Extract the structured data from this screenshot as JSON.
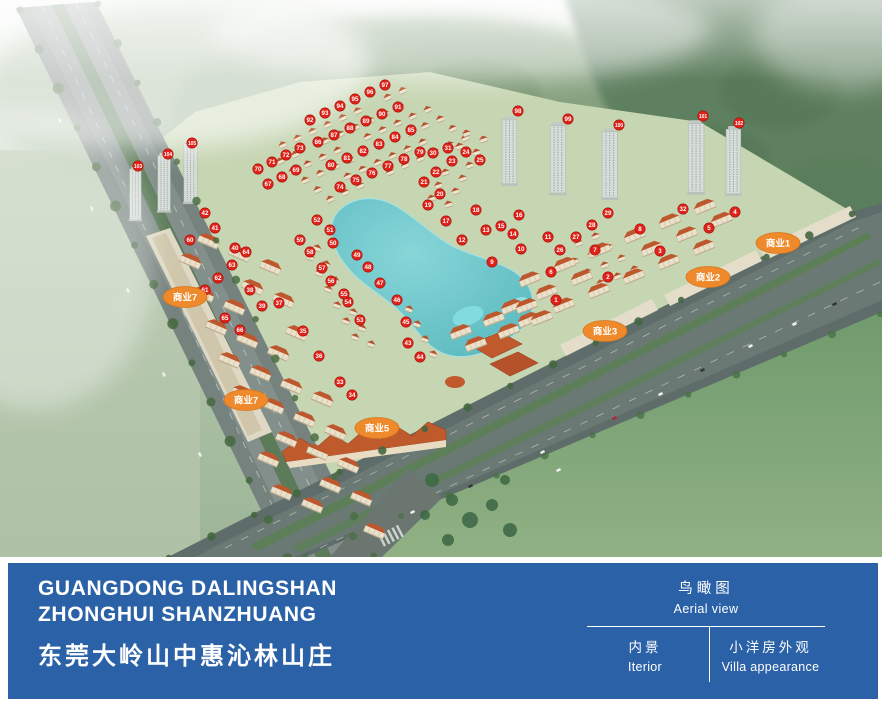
{
  "footer": {
    "bar_color": "#2b61a6",
    "title_en_line1": "GUANGDONG DALINGSHAN",
    "title_en_line2": "ZHONGHUI SHANZHUANG",
    "title_cn": "东莞大岭山中惠沁林山庄",
    "nav": {
      "active": {
        "cn": "鸟瞰图",
        "en": "Aerial view"
      },
      "items": [
        {
          "cn": "内景",
          "en": "Iterior"
        },
        {
          "cn": "小洋房外观",
          "en": "Villa appearance"
        }
      ]
    }
  },
  "aerial": {
    "marker_color": "#e0231a",
    "label_color": "#ee8a2b",
    "commercial_labels": [
      {
        "text": "商业1",
        "x": 778,
        "y": 243
      },
      {
        "text": "商业2",
        "x": 708,
        "y": 277
      },
      {
        "text": "商业3",
        "x": 605,
        "y": 331
      },
      {
        "text": "商业5",
        "x": 377,
        "y": 428
      },
      {
        "text": "商业7",
        "x": 185,
        "y": 297
      },
      {
        "text": "商业7",
        "x": 246,
        "y": 400
      }
    ],
    "unit_markers": [
      {
        "n": "1",
        "x": 556,
        "y": 300
      },
      {
        "n": "2",
        "x": 608,
        "y": 277
      },
      {
        "n": "3",
        "x": 660,
        "y": 251
      },
      {
        "n": "4",
        "x": 735,
        "y": 212
      },
      {
        "n": "5",
        "x": 709,
        "y": 228
      },
      {
        "n": "6",
        "x": 551,
        "y": 272
      },
      {
        "n": "7",
        "x": 595,
        "y": 250
      },
      {
        "n": "8",
        "x": 640,
        "y": 229
      },
      {
        "n": "9",
        "x": 492,
        "y": 262
      },
      {
        "n": "10",
        "x": 521,
        "y": 249
      },
      {
        "n": "11",
        "x": 548,
        "y": 237
      },
      {
        "n": "12",
        "x": 462,
        "y": 240
      },
      {
        "n": "13",
        "x": 486,
        "y": 230
      },
      {
        "n": "14",
        "x": 513,
        "y": 234
      },
      {
        "n": "15",
        "x": 501,
        "y": 226
      },
      {
        "n": "16",
        "x": 519,
        "y": 215
      },
      {
        "n": "17",
        "x": 446,
        "y": 221
      },
      {
        "n": "18",
        "x": 476,
        "y": 210
      },
      {
        "n": "19",
        "x": 428,
        "y": 205
      },
      {
        "n": "20",
        "x": 440,
        "y": 194
      },
      {
        "n": "21",
        "x": 424,
        "y": 182
      },
      {
        "n": "22",
        "x": 436,
        "y": 172
      },
      {
        "n": "23",
        "x": 452,
        "y": 161
      },
      {
        "n": "24",
        "x": 466,
        "y": 152
      },
      {
        "n": "25",
        "x": 480,
        "y": 160
      },
      {
        "n": "26",
        "x": 560,
        "y": 250
      },
      {
        "n": "27",
        "x": 576,
        "y": 237
      },
      {
        "n": "28",
        "x": 592,
        "y": 225
      },
      {
        "n": "29",
        "x": 608,
        "y": 213
      },
      {
        "n": "30",
        "x": 433,
        "y": 153
      },
      {
        "n": "31",
        "x": 448,
        "y": 148
      },
      {
        "n": "32",
        "x": 683,
        "y": 209
      },
      {
        "n": "33",
        "x": 340,
        "y": 382
      },
      {
        "n": "34",
        "x": 352,
        "y": 395
      },
      {
        "n": "35",
        "x": 303,
        "y": 331
      },
      {
        "n": "36",
        "x": 319,
        "y": 356
      },
      {
        "n": "37",
        "x": 279,
        "y": 303
      },
      {
        "n": "38",
        "x": 250,
        "y": 290
      },
      {
        "n": "39",
        "x": 262,
        "y": 306
      },
      {
        "n": "40",
        "x": 235,
        "y": 248
      },
      {
        "n": "41",
        "x": 215,
        "y": 228
      },
      {
        "n": "42",
        "x": 205,
        "y": 213
      },
      {
        "n": "43",
        "x": 408,
        "y": 343
      },
      {
        "n": "44",
        "x": 420,
        "y": 357
      },
      {
        "n": "45",
        "x": 406,
        "y": 322
      },
      {
        "n": "46",
        "x": 397,
        "y": 300
      },
      {
        "n": "47",
        "x": 380,
        "y": 283
      },
      {
        "n": "48",
        "x": 368,
        "y": 267
      },
      {
        "n": "49",
        "x": 357,
        "y": 255
      },
      {
        "n": "50",
        "x": 333,
        "y": 243
      },
      {
        "n": "51",
        "x": 330,
        "y": 230
      },
      {
        "n": "52",
        "x": 317,
        "y": 220
      },
      {
        "n": "53",
        "x": 360,
        "y": 320
      },
      {
        "n": "54",
        "x": 348,
        "y": 302
      },
      {
        "n": "55",
        "x": 344,
        "y": 294
      },
      {
        "n": "56",
        "x": 331,
        "y": 281
      },
      {
        "n": "57",
        "x": 322,
        "y": 268
      },
      {
        "n": "58",
        "x": 310,
        "y": 252
      },
      {
        "n": "59",
        "x": 300,
        "y": 240
      },
      {
        "n": "60",
        "x": 190,
        "y": 240
      },
      {
        "n": "61",
        "x": 205,
        "y": 290
      },
      {
        "n": "62",
        "x": 218,
        "y": 278
      },
      {
        "n": "63",
        "x": 232,
        "y": 265
      },
      {
        "n": "64",
        "x": 246,
        "y": 252
      },
      {
        "n": "65",
        "x": 225,
        "y": 318
      },
      {
        "n": "66",
        "x": 240,
        "y": 330
      },
      {
        "n": "67",
        "x": 268,
        "y": 184
      },
      {
        "n": "68",
        "x": 282,
        "y": 177
      },
      {
        "n": "69",
        "x": 296,
        "y": 170
      },
      {
        "n": "70",
        "x": 258,
        "y": 169
      },
      {
        "n": "71",
        "x": 272,
        "y": 162
      },
      {
        "n": "72",
        "x": 286,
        "y": 155
      },
      {
        "n": "73",
        "x": 300,
        "y": 148
      },
      {
        "n": "74",
        "x": 340,
        "y": 187
      },
      {
        "n": "75",
        "x": 356,
        "y": 180
      },
      {
        "n": "76",
        "x": 372,
        "y": 173
      },
      {
        "n": "77",
        "x": 388,
        "y": 166
      },
      {
        "n": "78",
        "x": 404,
        "y": 159
      },
      {
        "n": "79",
        "x": 420,
        "y": 152
      },
      {
        "n": "80",
        "x": 331,
        "y": 165
      },
      {
        "n": "81",
        "x": 347,
        "y": 158
      },
      {
        "n": "82",
        "x": 363,
        "y": 151
      },
      {
        "n": "83",
        "x": 379,
        "y": 144
      },
      {
        "n": "84",
        "x": 395,
        "y": 137
      },
      {
        "n": "85",
        "x": 411,
        "y": 130
      },
      {
        "n": "86",
        "x": 318,
        "y": 142
      },
      {
        "n": "87",
        "x": 334,
        "y": 135
      },
      {
        "n": "88",
        "x": 350,
        "y": 128
      },
      {
        "n": "89",
        "x": 366,
        "y": 121
      },
      {
        "n": "90",
        "x": 382,
        "y": 114
      },
      {
        "n": "91",
        "x": 398,
        "y": 107
      },
      {
        "n": "92",
        "x": 310,
        "y": 120
      },
      {
        "n": "93",
        "x": 325,
        "y": 113
      },
      {
        "n": "94",
        "x": 340,
        "y": 106
      },
      {
        "n": "95",
        "x": 355,
        "y": 99
      },
      {
        "n": "96",
        "x": 370,
        "y": 92
      },
      {
        "n": "97",
        "x": 385,
        "y": 85
      },
      {
        "n": "98",
        "x": 518,
        "y": 111
      },
      {
        "n": "99",
        "x": 568,
        "y": 119
      },
      {
        "n": "100",
        "x": 619,
        "y": 125
      },
      {
        "n": "101",
        "x": 703,
        "y": 116
      },
      {
        "n": "102",
        "x": 739,
        "y": 123
      },
      {
        "n": "103",
        "x": 138,
        "y": 166
      },
      {
        "n": "104",
        "x": 168,
        "y": 154
      },
      {
        "n": "105",
        "x": 192,
        "y": 143
      }
    ]
  }
}
